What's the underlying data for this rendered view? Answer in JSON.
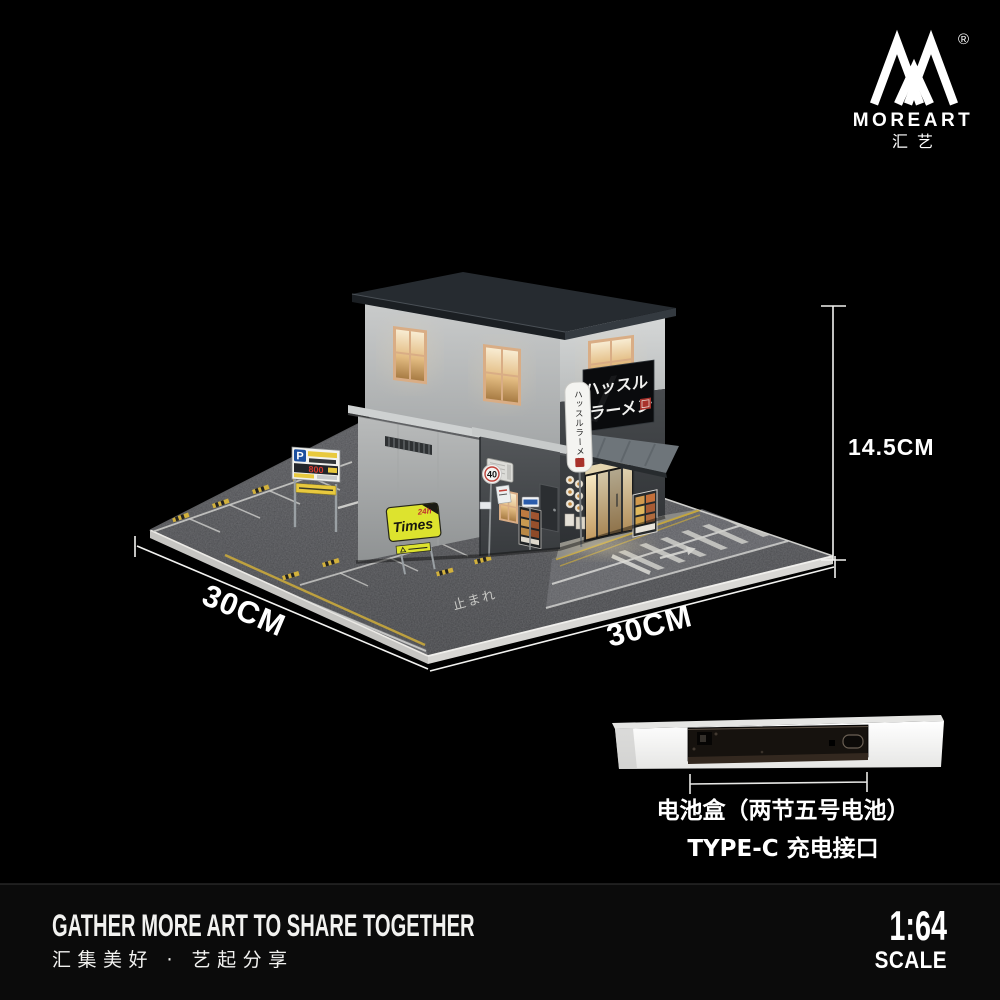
{
  "logo": {
    "brand": "MOREART",
    "brand_cn": "汇艺",
    "registered_mark": "®"
  },
  "dimensions": {
    "height_label": "14.5CM",
    "side_left_label": "30CM",
    "side_right_label": "30CM"
  },
  "diorama": {
    "shop_sign_line1": "ハッスル",
    "shop_sign_line2": "ラーメン",
    "vertical_sign_text": "ハッスルラーメン",
    "speed_limit_sign": "40",
    "parking_sign_letter": "P",
    "parking_sign_price": "800",
    "times_sign_text": "Times",
    "times_sign_hours": "24h",
    "road_text": "止まれ"
  },
  "battery_section": {
    "caption_line1": "电池盒（两节五号电池）",
    "caption_line2": "TYPE-C 充电接口"
  },
  "footer": {
    "slogan_en": "GATHER MORE ART TO SHARE TOGETHER",
    "slogan_cn": "汇集美好 · 艺起分享",
    "scale_ratio": "1:64",
    "scale_label": "SCALE"
  },
  "colors": {
    "background": "#000000",
    "accent_yellow": "#dde32e",
    "road_line_yellow": "#c9a93c",
    "warm_light": "#f2dda9",
    "roof_slate": "#262b30",
    "sign_red": "#a8322c",
    "parking_blue": "#1c4f9e",
    "wall_light": "#c6c8c8",
    "wall_dark": "#3f4245"
  }
}
